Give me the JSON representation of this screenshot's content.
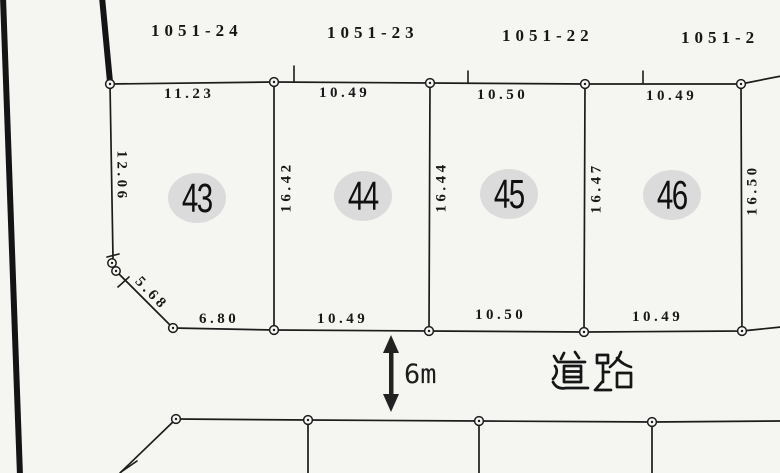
{
  "colors": {
    "paper": "#f5f5f2",
    "ink": "#1c1c1c",
    "plot_badge": "#dbdbdb"
  },
  "parcels": {
    "lot_numbers": [
      "1051-24",
      "1051-23",
      "1051-22",
      "1051-2"
    ],
    "plot_numbers": [
      "43",
      "44",
      "45",
      "46"
    ]
  },
  "measurements": {
    "top_edges": [
      "11.23",
      "10.49",
      "10.50",
      "10.49"
    ],
    "bottom_edges": [
      "6.80",
      "10.49",
      "10.50",
      "10.49"
    ],
    "left_edge": "12.06",
    "dividers": [
      "16.42",
      "16.44",
      "16.47"
    ],
    "right_edge": "16.50",
    "diagonal": "5.68"
  },
  "road": {
    "name": "道路",
    "width": "6m"
  }
}
